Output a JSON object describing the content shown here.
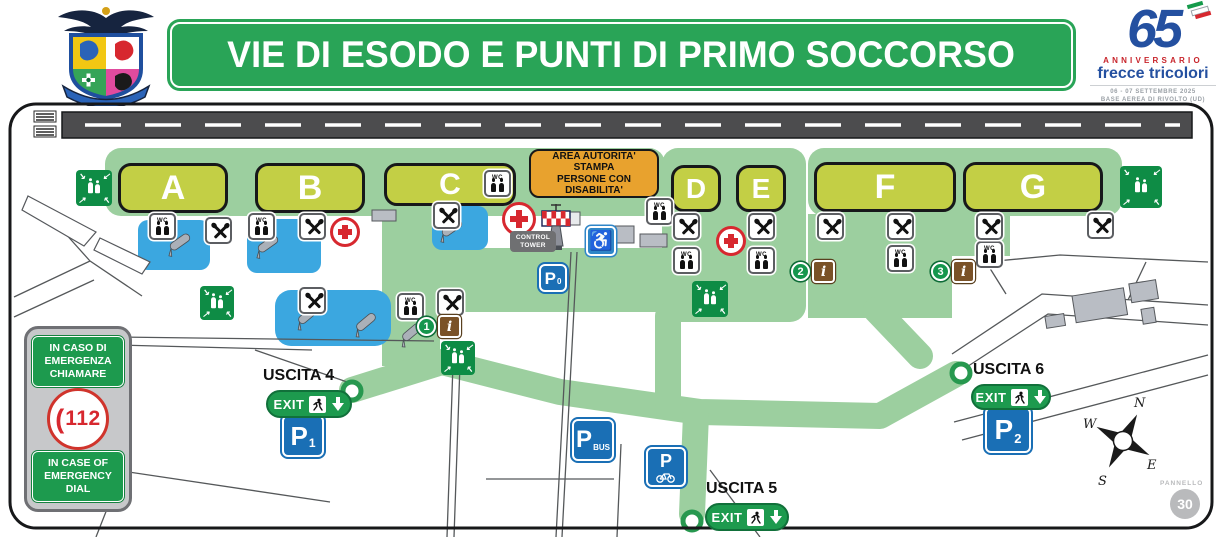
{
  "header": {
    "title": "VIE DI ESODO E PUNTI DI PRIMO SOCCORSO",
    "logo": {
      "number": "65",
      "anniversario": "ANNIVERSARIO",
      "brand": "frecce tricolori",
      "date": "06 - 07 SETTEMBRE 2025",
      "base": "BASE AEREA DI RIVOLTO (UD)"
    }
  },
  "map": {
    "zones": [
      {
        "label": "A"
      },
      {
        "label": "B"
      },
      {
        "label": "C"
      },
      {
        "label": "D"
      },
      {
        "label": "E"
      },
      {
        "label": "F"
      },
      {
        "label": "G"
      }
    ],
    "authority_box": {
      "line1": "AREA AUTORITA'",
      "line2": "STAMPA",
      "line3": "PERSONE CON",
      "line4": "DISABILITA'"
    },
    "control_tower": "CONTROL TOWER",
    "wc_label": "WC",
    "info_label": "i",
    "markers": [
      "1",
      "2",
      "3"
    ],
    "parking": {
      "p": "P",
      "p0_sub": "0",
      "p1_sub": "1",
      "p2_sub": "2",
      "pbus_sub": "BUS"
    },
    "exits": [
      {
        "name": "USCITA 4"
      },
      {
        "name": "USCITA 5"
      },
      {
        "name": "USCITA 6"
      }
    ],
    "exit_word": "EXIT",
    "emergency": {
      "it": [
        "IN CASO DI",
        "EMERGENZA",
        "CHIAMARE"
      ],
      "number": "112",
      "en": [
        "IN CASE OF",
        "EMERGENCY",
        "DIAL"
      ]
    },
    "compass": {
      "n": "N",
      "e": "E",
      "s": "S",
      "w": "W"
    },
    "panel": {
      "label": "PANNELLO",
      "number": "30"
    }
  },
  "colors": {
    "banner_green": "#29a457",
    "zone_yellow": "#c3cf45",
    "route_green": "#9ccf9f",
    "assembly_green": "#0e8c45",
    "parking_blue": "#1a6fb5",
    "authority_orange": "#e8a22e",
    "emergency_red": "#d7282f",
    "info_brown": "#7a5228",
    "logo_blue": "#2450a0"
  }
}
